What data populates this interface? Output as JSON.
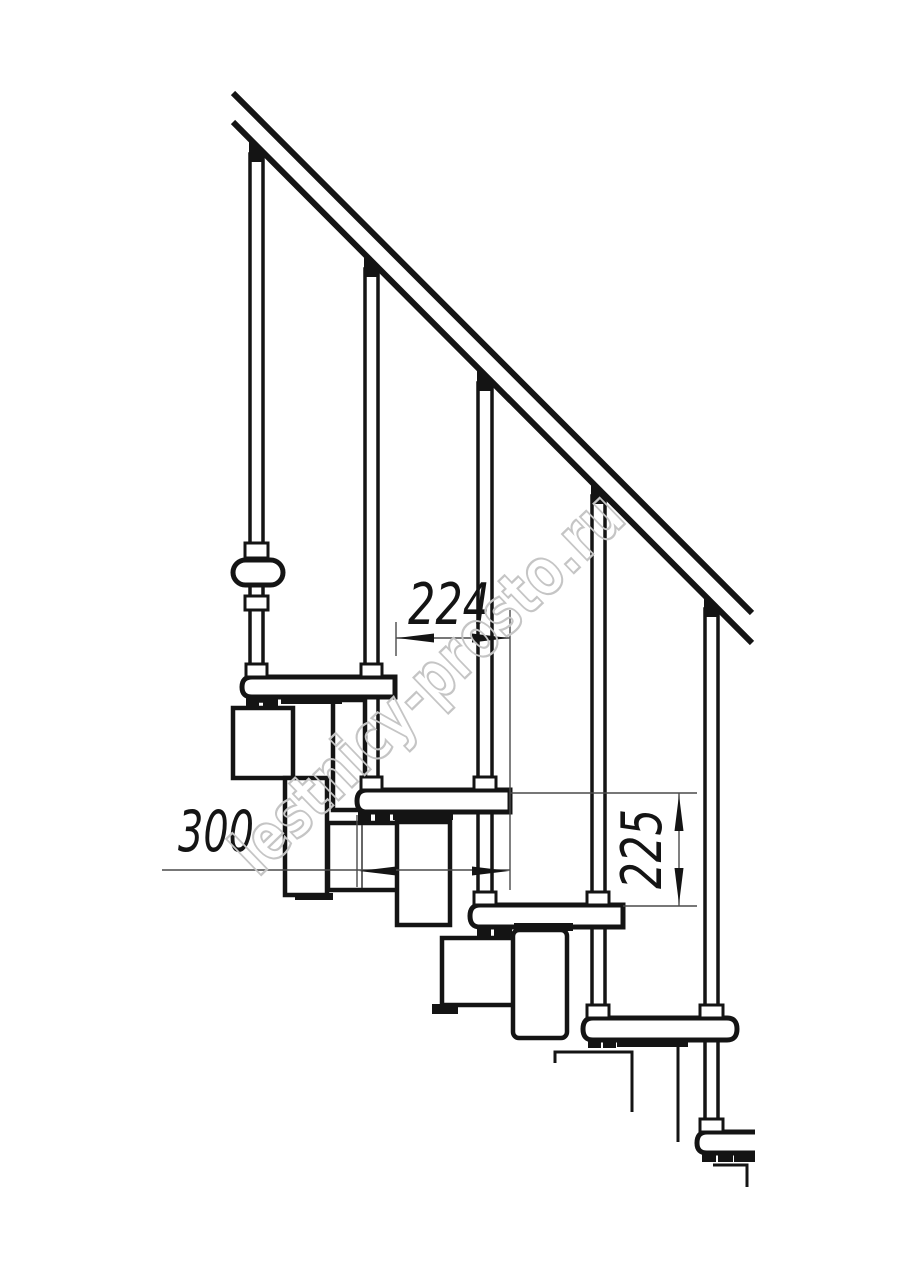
{
  "drawing": {
    "title": "Modular staircase side elevation technical drawing",
    "watermark": "lestnicy-prosto.ru",
    "dimensions": {
      "tread_run": "224",
      "tread_depth": "300",
      "riser_height": "225"
    },
    "colors": {
      "line": "#141414",
      "dim_line": "#4a4a4a",
      "watermark": "#c5c5c5",
      "background": "#ffffff"
    }
  }
}
